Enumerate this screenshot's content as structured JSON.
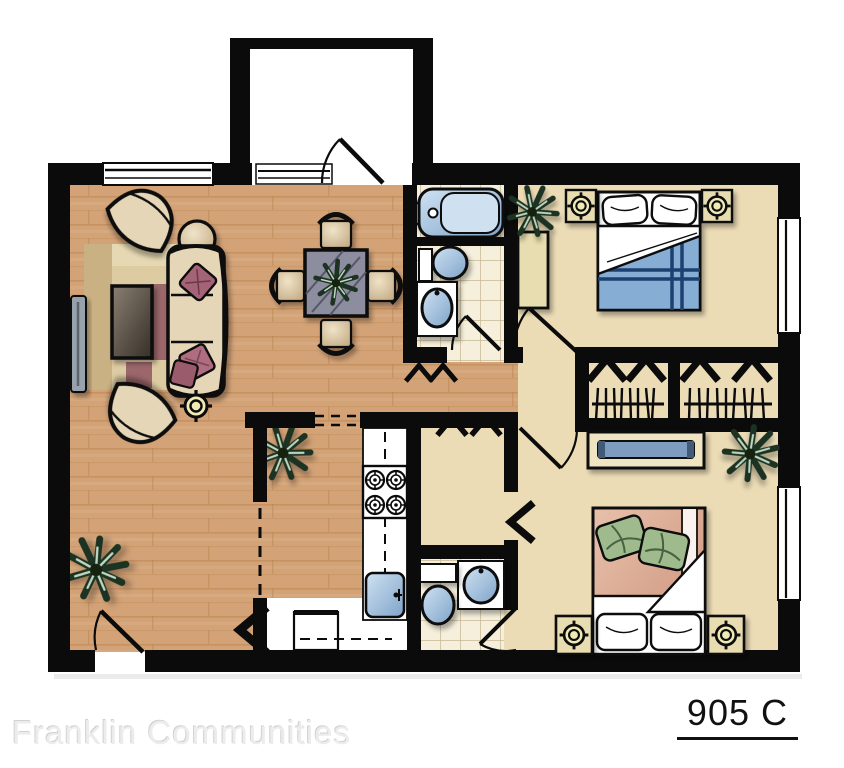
{
  "branding": {
    "company": "Franklin Communities",
    "unit": "905 C"
  },
  "palette": {
    "wall": "#0b0b0b",
    "wood": "#d3a277",
    "wood_seam": "#b9854f",
    "carpet": "#ecdcb6",
    "tile": "#f5efdc",
    "tile_line": "#c8b995",
    "fixture_blue_light": "#cfe2f2",
    "fixture_blue_dark": "#7fa3c9",
    "furniture_tan": "#e6d6b8",
    "accent_maroon": "#9a5b6d",
    "plant_green": "#1e3320",
    "table_slate": "#8d8da0",
    "blanket_blue": "#86add4",
    "blanket_stripe": "#1d4170",
    "blanket_salmon": "#d9a58e",
    "pillow_green": "#9fbb8e",
    "lamp_yellow": "#efe9b4",
    "tv_gray": "#98a2ac",
    "kitchen_white": "#ffffff"
  },
  "rooms": [
    {
      "name": "living-room",
      "floor": "wood"
    },
    {
      "name": "dining-area",
      "floor": "wood"
    },
    {
      "name": "entry-vestibule",
      "floor": "vinyl"
    },
    {
      "name": "kitchen",
      "floor": "vinyl"
    },
    {
      "name": "hallway",
      "floor": "wood"
    },
    {
      "name": "bathroom-1",
      "floor": "tile"
    },
    {
      "name": "bathroom-2",
      "floor": "tile"
    },
    {
      "name": "bedroom-1",
      "floor": "carpet"
    },
    {
      "name": "bedroom-2",
      "floor": "carpet"
    },
    {
      "name": "closets",
      "floor": "carpet"
    }
  ],
  "symbols": [
    {
      "name": "sofa",
      "count": 1
    },
    {
      "name": "accent-chair",
      "count": 2
    },
    {
      "name": "coffee-table",
      "count": 1
    },
    {
      "name": "round-side-table",
      "count": 1
    },
    {
      "name": "area-rug",
      "count": 1
    },
    {
      "name": "tv",
      "count": 1
    },
    {
      "name": "floor-lamp",
      "count": 1
    },
    {
      "name": "table-lamp",
      "count": 4
    },
    {
      "name": "dining-table",
      "count": 1
    },
    {
      "name": "dining-chair",
      "count": 4
    },
    {
      "name": "houseplant",
      "count": 5
    },
    {
      "name": "bathtub",
      "count": 1
    },
    {
      "name": "toilet",
      "count": 2
    },
    {
      "name": "bathroom-sink",
      "count": 2
    },
    {
      "name": "kitchen-range",
      "count": 1
    },
    {
      "name": "kitchen-sink",
      "count": 1
    },
    {
      "name": "refrigerator",
      "count": 1
    },
    {
      "name": "bed",
      "count": 2
    },
    {
      "name": "nightstand",
      "count": 4
    },
    {
      "name": "dresser",
      "count": 3
    },
    {
      "name": "closet-rod",
      "count": 2
    },
    {
      "name": "hanger-hooks",
      "count": 10
    },
    {
      "name": "window",
      "count": 4
    },
    {
      "name": "door-swing",
      "count": 6
    },
    {
      "name": "open-door-chevron",
      "count": 2
    }
  ]
}
